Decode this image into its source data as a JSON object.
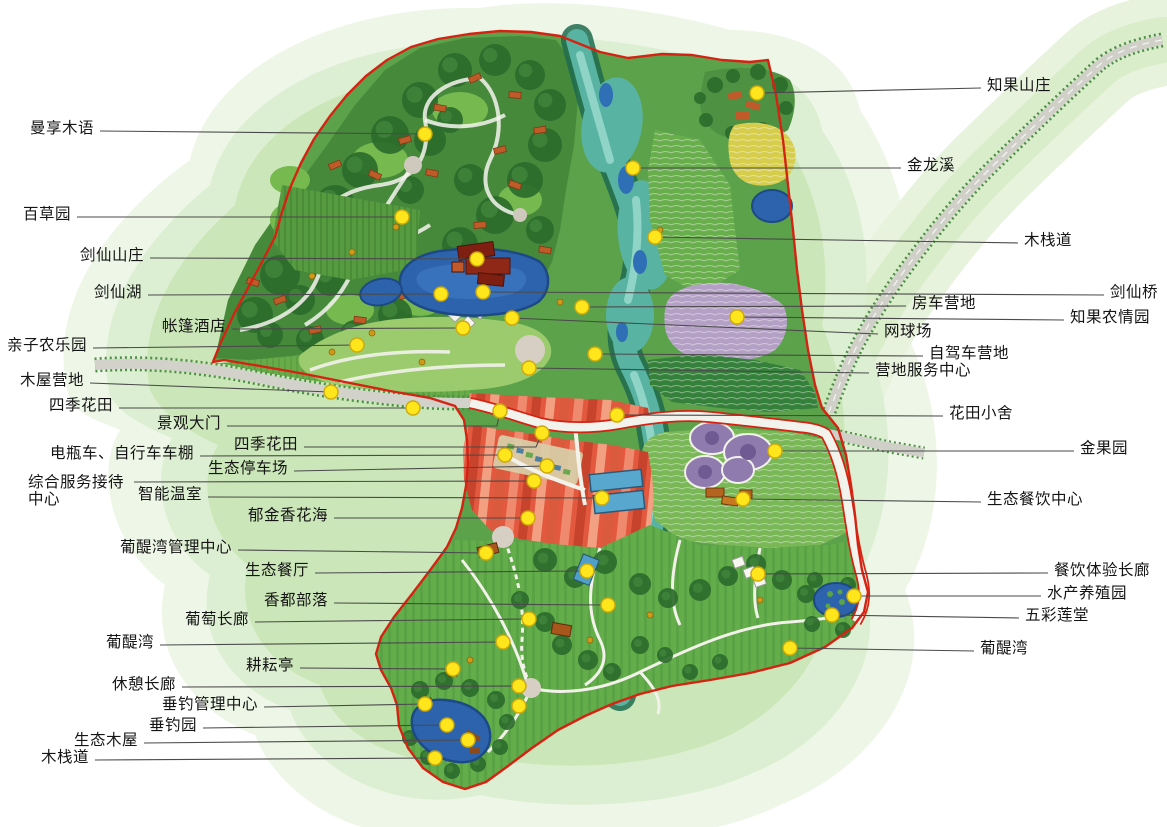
{
  "map": {
    "kind": "resort-master-plan",
    "language": "zh-CN",
    "colors": {
      "marker_fill": "#ffe51c",
      "marker_stroke": "#cda90a",
      "leader": "#4a4a4a",
      "boundary_red": "#d42313",
      "label_text": "#141414",
      "water_blue": "#2d63ad",
      "river_teal": "#58b3a2",
      "halo_green": "#d9eecb"
    },
    "markers": [
      {
        "label": "曼享木语",
        "side": "left",
        "lx": 100,
        "ly": 131,
        "dx": 425,
        "dy": 134
      },
      {
        "label": "百草园",
        "side": "left",
        "lx": 77,
        "ly": 217,
        "dx": 402,
        "dy": 217
      },
      {
        "label": "剑仙山庄",
        "side": "left",
        "lx": 150,
        "ly": 258,
        "dx": 477,
        "dy": 259
      },
      {
        "label": "剑仙湖",
        "side": "left",
        "lx": 148,
        "ly": 295,
        "dx": 441,
        "dy": 294
      },
      {
        "label": "帐篷酒店",
        "side": "left",
        "lx": 232,
        "ly": 329,
        "dx": 463,
        "dy": 328
      },
      {
        "label": "亲子农乐园",
        "side": "left",
        "lx": 93,
        "ly": 348,
        "dx": 357,
        "dy": 345
      },
      {
        "label": "木屋营地",
        "side": "left",
        "lx": 90,
        "ly": 383,
        "dx": 331,
        "dy": 392
      },
      {
        "label": "四季花田",
        "side": "left",
        "lx": 119,
        "ly": 408,
        "dx": 413,
        "dy": 408
      },
      {
        "label": "景观大门",
        "side": "left",
        "lx": 227,
        "ly": 426,
        "via": [
          [
            497,
            426
          ]
        ],
        "dx": 500,
        "dy": 411
      },
      {
        "label": "四季花田",
        "side": "left",
        "lx": 304,
        "ly": 447,
        "via": [
          [
            536,
            447
          ]
        ],
        "dx": 542,
        "dy": 433
      },
      {
        "label": "电瓶车、自行车车棚",
        "side": "left",
        "lx": 200,
        "ly": 456,
        "dx": 505,
        "dy": 455
      },
      {
        "label": "生态停车场",
        "side": "left",
        "lx": 294,
        "ly": 471,
        "dx": 547,
        "dy": 466
      },
      {
        "label": "综合服务接待中心",
        "lines": [
          "综合服务接待",
          "中心"
        ],
        "side": "left",
        "tx": 28,
        "ty": 474,
        "lx": 134,
        "ly": 482,
        "dx": 534,
        "dy": 481
      },
      {
        "label": "智能温室",
        "side": "left",
        "lx": 208,
        "ly": 497,
        "dx": 602,
        "dy": 498
      },
      {
        "label": "郁金香花海",
        "side": "left",
        "lx": 334,
        "ly": 518,
        "dx": 528,
        "dy": 518
      },
      {
        "label": "葡醍湾管理中心",
        "side": "left",
        "lx": 238,
        "ly": 550,
        "dx": 486,
        "dy": 553
      },
      {
        "label": "生态餐厅",
        "side": "left",
        "lx": 315,
        "ly": 573,
        "dx": 587,
        "dy": 571
      },
      {
        "label": "香都部落",
        "side": "left",
        "lx": 334,
        "ly": 603,
        "dx": 608,
        "dy": 605
      },
      {
        "label": "葡萄长廊",
        "side": "left",
        "lx": 255,
        "ly": 622,
        "dx": 529,
        "dy": 619
      },
      {
        "label": "葡醍湾",
        "side": "left",
        "lx": 160,
        "ly": 645,
        "dx": 503,
        "dy": 642
      },
      {
        "label": "耕耘亭",
        "side": "left",
        "lx": 300,
        "ly": 668,
        "dx": 453,
        "dy": 669
      },
      {
        "label": "休憩长廊",
        "side": "left",
        "lx": 182,
        "ly": 687,
        "dx": 519,
        "dy": 686
      },
      {
        "label": "垂钓管理中心",
        "side": "left",
        "lx": 264,
        "ly": 707,
        "dx": 425,
        "dy": 704
      },
      {
        "label": "垂钓园",
        "side": "left",
        "lx": 203,
        "ly": 728,
        "dx": 447,
        "dy": 725
      },
      {
        "label": "生态木屋",
        "side": "left",
        "lx": 144,
        "ly": 743,
        "dx": 468,
        "dy": 740
      },
      {
        "label": "木栈道",
        "side": "left",
        "lx": 95,
        "ly": 760,
        "dx": 435,
        "dy": 758
      },
      {
        "label": "知果山庄",
        "side": "right",
        "lx": 981,
        "ly": 88,
        "dx": 757,
        "dy": 93
      },
      {
        "label": "金龙溪",
        "side": "right",
        "lx": 901,
        "ly": 168,
        "dx": 633,
        "dy": 168
      },
      {
        "label": "木栈道",
        "side": "right",
        "lx": 1018,
        "ly": 243,
        "dx": 655,
        "dy": 237
      },
      {
        "label": "剑仙桥",
        "side": "right",
        "lx": 1104,
        "ly": 295,
        "dx": 483,
        "dy": 292
      },
      {
        "label": "房车营地",
        "side": "right",
        "lx": 906,
        "ly": 306,
        "dx": 582,
        "dy": 307
      },
      {
        "label": "知果农情园",
        "side": "right",
        "lx": 1064,
        "ly": 320,
        "dx": 737,
        "dy": 317
      },
      {
        "label": "网球场",
        "side": "right",
        "lx": 878,
        "ly": 334,
        "dx": 512,
        "dy": 318
      },
      {
        "label": "自驾车营地",
        "side": "right",
        "lx": 923,
        "ly": 356,
        "dx": 595,
        "dy": 354
      },
      {
        "label": "营地服务中心",
        "side": "right",
        "lx": 869,
        "ly": 373,
        "dx": 529,
        "dy": 368
      },
      {
        "label": "花田小舍",
        "side": "right",
        "lx": 943,
        "ly": 416,
        "dx": 617,
        "dy": 415
      },
      {
        "label": "金果园",
        "side": "right",
        "lx": 1074,
        "ly": 451,
        "dx": 775,
        "dy": 451
      },
      {
        "label": "生态餐饮中心",
        "side": "right",
        "lx": 981,
        "ly": 502,
        "dx": 743,
        "dy": 499
      },
      {
        "label": "餐饮体验长廊",
        "side": "right",
        "lx": 1048,
        "ly": 573,
        "dx": 758,
        "dy": 574
      },
      {
        "label": "水产养殖园",
        "side": "right",
        "lx": 1041,
        "ly": 596,
        "dx": 854,
        "dy": 596
      },
      {
        "label": "五彩莲堂",
        "side": "right",
        "lx": 1019,
        "ly": 618,
        "dx": 832,
        "dy": 615
      },
      {
        "label": "葡醍湾",
        "side": "right",
        "lx": 974,
        "ly": 651,
        "dx": 790,
        "dy": 648
      }
    ],
    "extra_dots": [
      {
        "x": 519,
        "y": 706
      }
    ]
  }
}
